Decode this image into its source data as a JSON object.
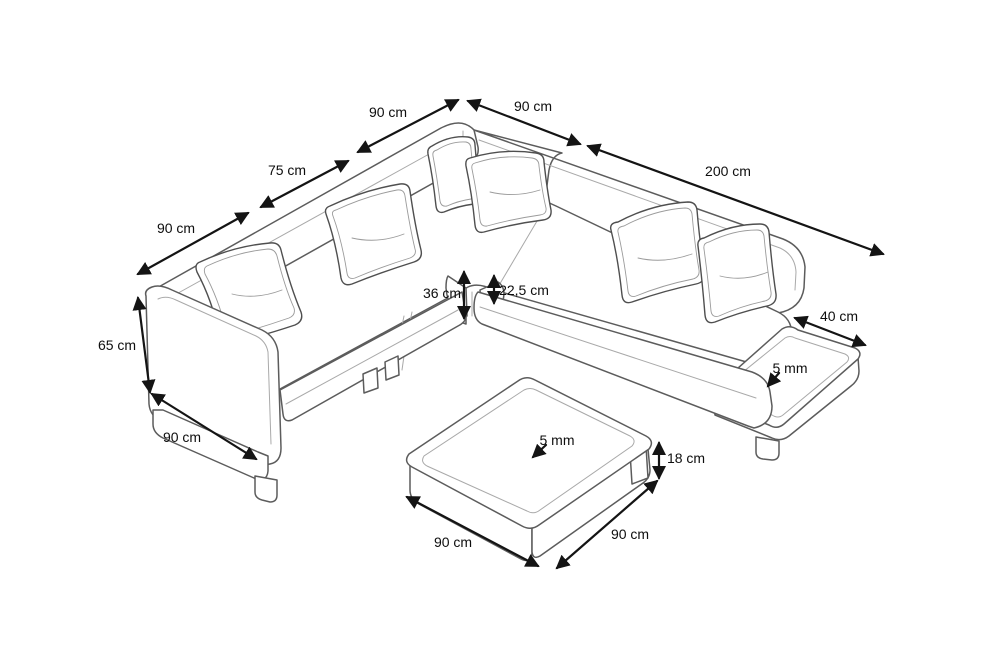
{
  "diagram": {
    "type": "furniture-dimension-diagram",
    "subject": "corner sofa with chaise, attached side table and square coffee table",
    "background_color": "#ffffff",
    "outline_color": "#5c5c5c",
    "dimension_color": "#141414"
  },
  "dimensions": [
    {
      "id": "back-left-segment-width",
      "label": "90 cm",
      "value": 90,
      "unit": "cm"
    },
    {
      "id": "back-right-segment-width",
      "label": "90 cm",
      "value": 90,
      "unit": "cm"
    },
    {
      "id": "left-backrest-length",
      "label": "75 cm",
      "value": 75,
      "unit": "cm"
    },
    {
      "id": "chaise-section-length",
      "label": "200 cm",
      "value": 200,
      "unit": "cm"
    },
    {
      "id": "left-side-depth",
      "label": "90 cm",
      "value": 90,
      "unit": "cm"
    },
    {
      "id": "overall-height",
      "label": "65 cm",
      "value": 65,
      "unit": "cm"
    },
    {
      "id": "seat-height",
      "label": "36 cm",
      "value": 36,
      "unit": "cm"
    },
    {
      "id": "platform-height",
      "label": "22,5 cm",
      "value": 22.5,
      "unit": "cm"
    },
    {
      "id": "side-table-depth",
      "label": "40 cm",
      "value": 40,
      "unit": "cm"
    },
    {
      "id": "side-table-top-thickness",
      "label": "5 mm",
      "value": 5,
      "unit": "mm"
    },
    {
      "id": "armrest-front-width",
      "label": "90 cm",
      "value": 90,
      "unit": "cm"
    },
    {
      "id": "coffee-table-top-thickness",
      "label": "5 mm",
      "value": 5,
      "unit": "mm"
    },
    {
      "id": "coffee-table-height",
      "label": "18 cm",
      "value": 18,
      "unit": "cm"
    },
    {
      "id": "coffee-table-width",
      "label": "90 cm",
      "value": 90,
      "unit": "cm"
    },
    {
      "id": "coffee-table-depth",
      "label": "90 cm",
      "value": 90,
      "unit": "cm"
    }
  ]
}
